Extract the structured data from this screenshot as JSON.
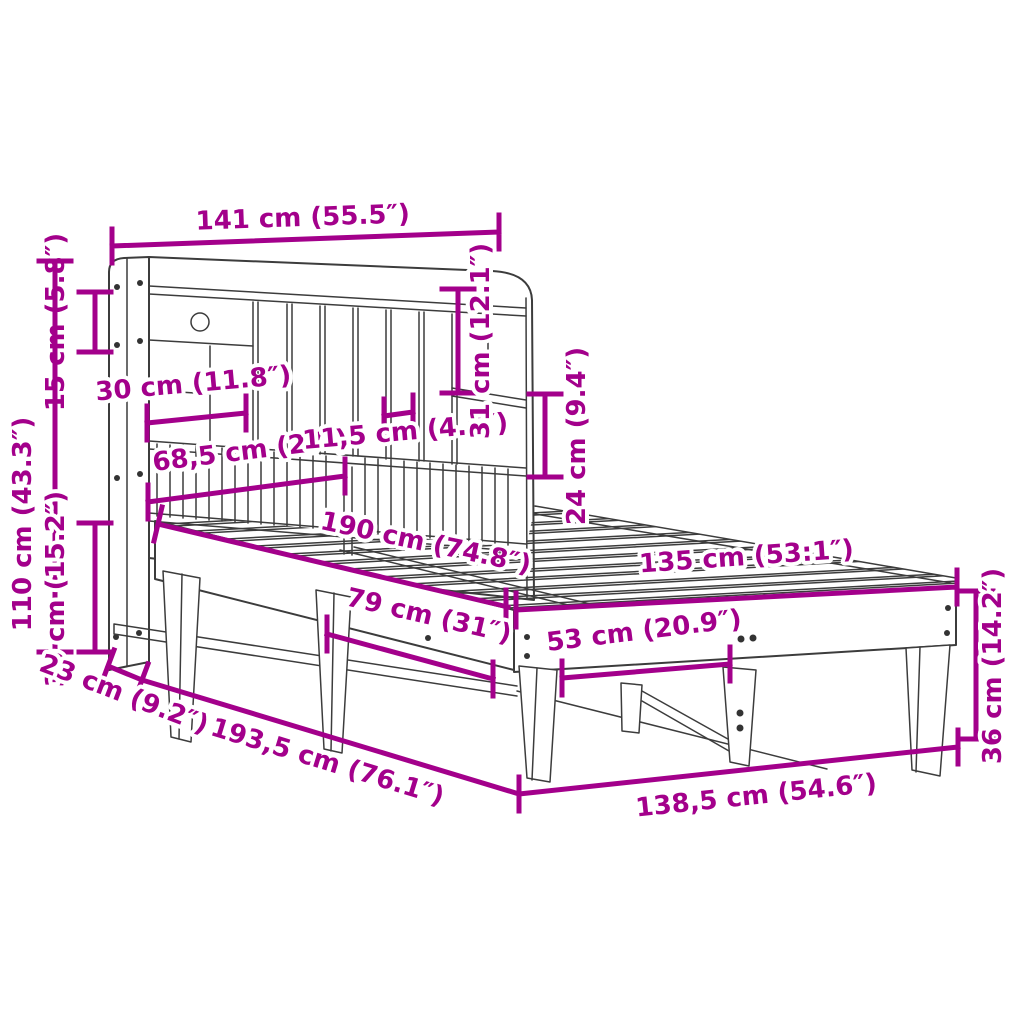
{
  "figure": {
    "type": "product dimension diagram",
    "subject": "bed frame with bookcase headboard, line drawing with dimension arrows"
  },
  "colors": {
    "dimension_accent": "#a3008b",
    "line_art": "#3c3c3c",
    "background": "#ffffff"
  },
  "dimensions": {
    "headboard_width": "141 cm (55.5″)",
    "shelf_height": "15 cm (5.8″)",
    "headboard_height": "110 cm (43.3″)",
    "base_height": "39 cm (15.2″)",
    "compartment_width": "30 cm (11.8″)",
    "rail_section_width": "68,5 cm (27″)",
    "slot_width": "11,5 cm (4.5″)",
    "compartment_height": "31 cm (12.1″)",
    "rail_section_height": "24 cm (9.4″)",
    "mattress_length": "190 cm (74.8″)",
    "mattress_width": "135 cm (53:1″)",
    "side_rail_length": "79 cm (31″)",
    "footboard_section_width": "53 cm (20.9″)",
    "headboard_depth": "23 cm (9.2″)",
    "frame_length": "193,5 cm (76.1″)",
    "frame_width": "138,5 cm (54.6″)",
    "frame_height": "36 cm (14.2″)"
  }
}
